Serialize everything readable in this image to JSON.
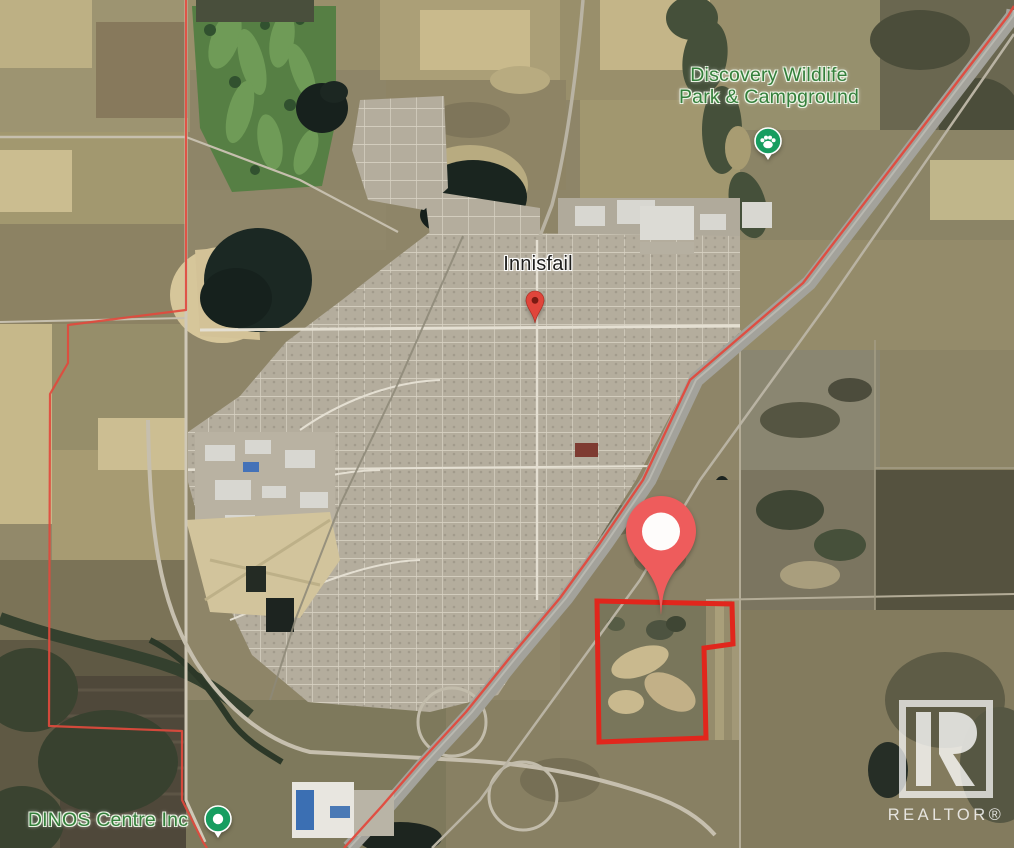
{
  "map": {
    "labels": {
      "wildlife_line1": "Discovery Wildlife",
      "wildlife_line2": "Park & Campground",
      "town": "Innisfail",
      "dinos": "DINOS Centre Inc"
    },
    "colors": {
      "poi_label_green": "#347f3b",
      "town_label": "#1e1e1c",
      "property_pin": "#ee5c5c",
      "town_pin": "#e0453b",
      "poi_pin_green": "#179d60",
      "boundary_line": "#e14a3d",
      "parcel_outline": "#e1261c"
    }
  },
  "watermark": {
    "brand": "REALTOR®"
  }
}
